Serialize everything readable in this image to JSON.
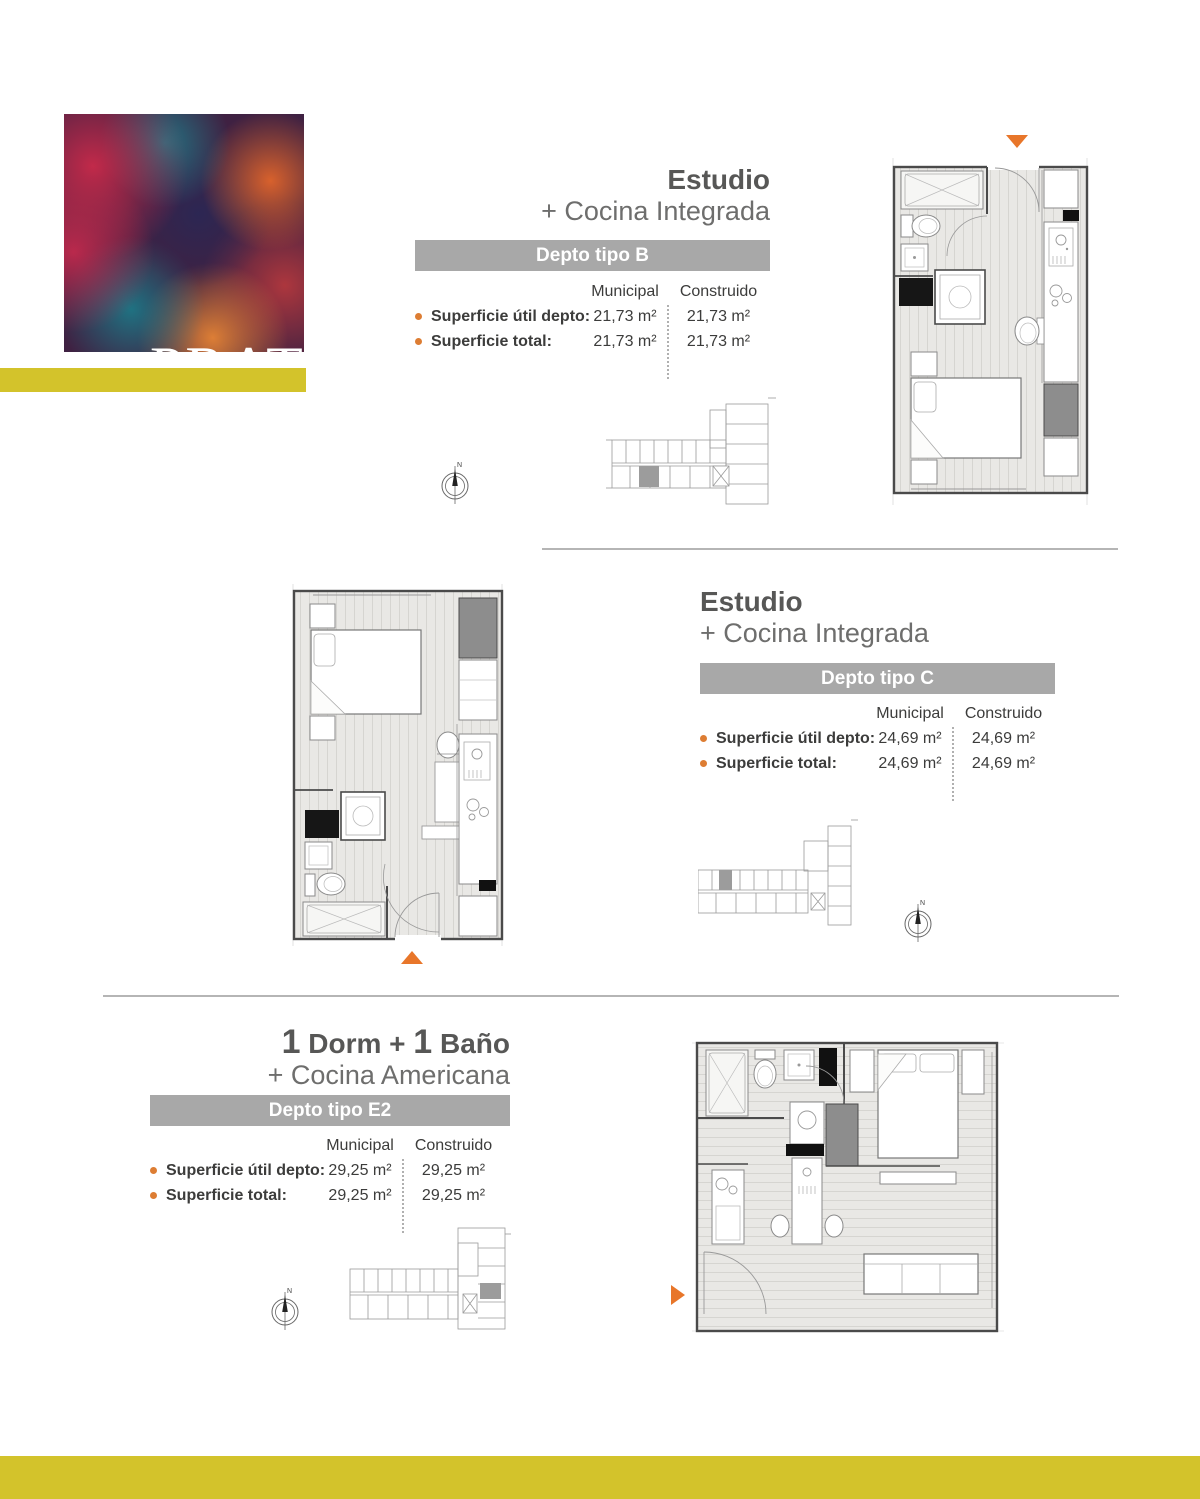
{
  "logo": {
    "text": "PRAT",
    "number": "631"
  },
  "colors": {
    "accent_yellow": "#d3c32b",
    "accent_orange": "#e8762a",
    "bullet_orange": "#dd7d33",
    "type_bar_gray": "#a8a8a8",
    "title_gray": "#575756"
  },
  "table": {
    "municipal": "Municipal",
    "construido": "Construido",
    "util_label": "Superficie útil depto:",
    "total_label": "Superficie total:"
  },
  "sections": [
    {
      "title1": "Estudio",
      "title2": "+ Cocina Integrada",
      "type": "Depto tipo B",
      "util_municipal": "21,73 m²",
      "util_construido": "21,73 m²",
      "total_municipal": "21,73 m²",
      "total_construido": "21,73 m²"
    },
    {
      "title1": "Estudio",
      "title2": "+ Cocina Integrada",
      "type": "Depto tipo C",
      "util_municipal": "24,69 m²",
      "util_construido": "24,69 m²",
      "total_municipal": "24,69 m²",
      "total_construido": "24,69 m²"
    },
    {
      "t1a": "1",
      "t1b": " Dorm + ",
      "t1c": "1",
      "t1d": " Baño",
      "title2": "+ Cocina Americana",
      "type": "Depto tipo E2",
      "util_municipal": "29,25 m²",
      "util_construido": "29,25 m²",
      "total_municipal": "29,25 m²",
      "total_construido": "29,25 m²"
    }
  ]
}
